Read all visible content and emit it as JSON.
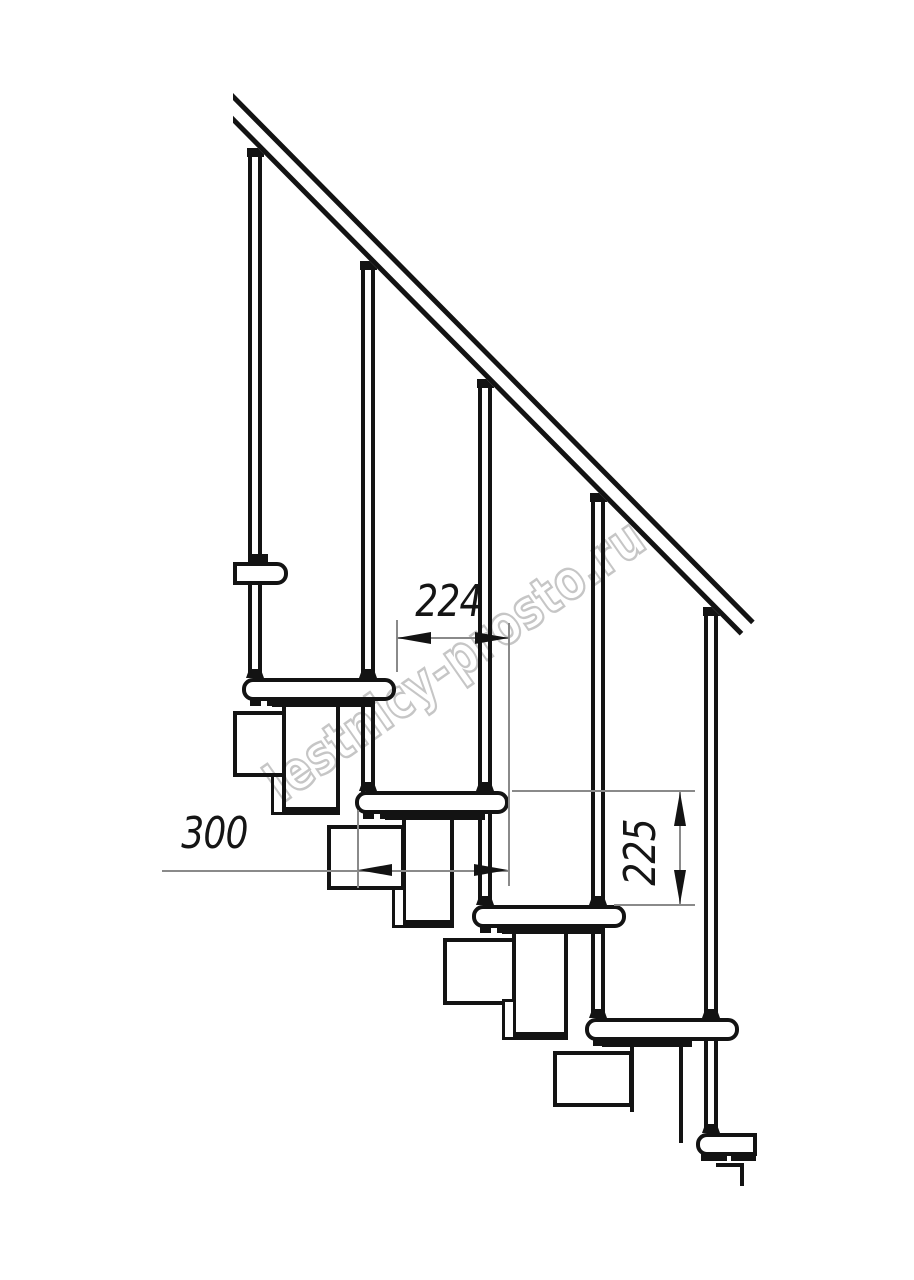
{
  "document": {
    "type": "technical-drawing",
    "subject": "modular staircase side elevation"
  },
  "watermark": {
    "text": "lestnicy-prosto.ru",
    "color": "#c6c6c6"
  },
  "dimensions": {
    "run_between_posts": "224",
    "tread_depth": "300",
    "step_rise": "225"
  },
  "colors": {
    "line": "#131313",
    "background": "#ffffff",
    "dimension_line": "#8a8a8a",
    "watermark": "#c6c6c6"
  }
}
